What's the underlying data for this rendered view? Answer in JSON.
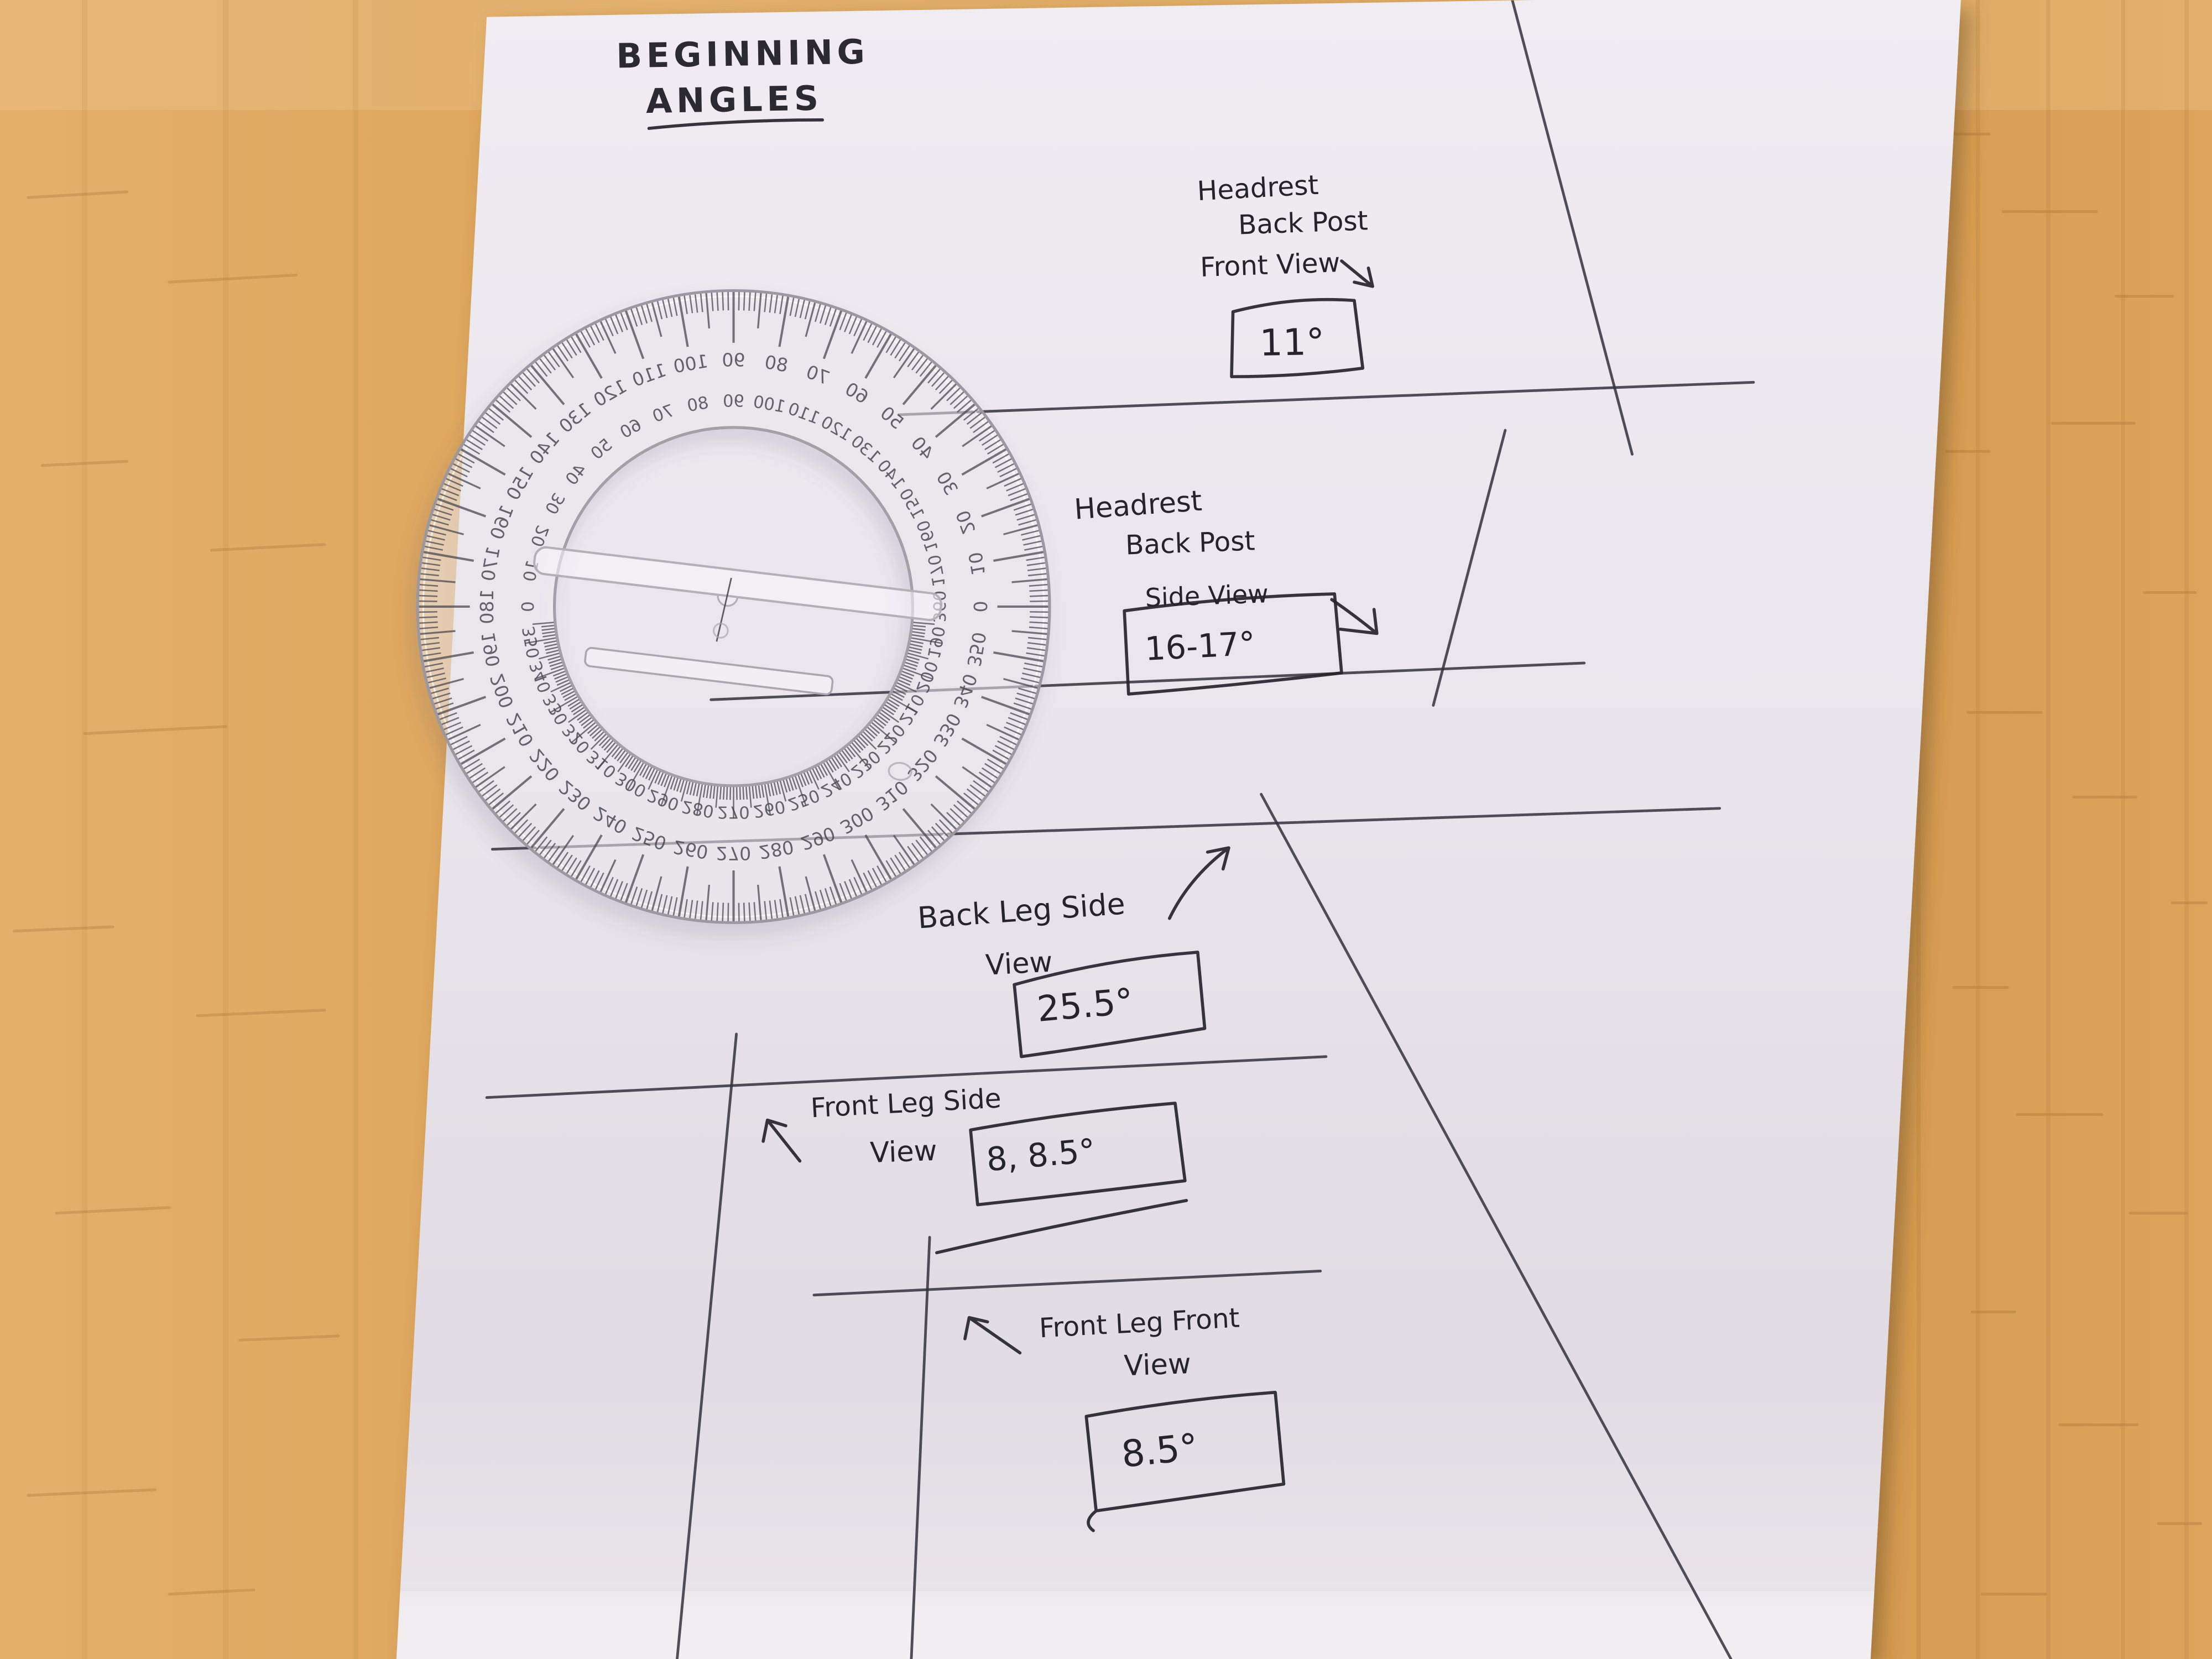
{
  "title": {
    "line1": "BEGINNING",
    "line2": "ANGLES"
  },
  "sections": {
    "headrest_front": {
      "l1": "Headrest",
      "l2": "Back Post",
      "l3": "Front View",
      "value": "11°"
    },
    "headrest_side": {
      "l1": "Headrest",
      "l2": "Back Post",
      "l3": "Side View",
      "value": "16-17°"
    },
    "back_leg_side": {
      "l1": "Back Leg Side",
      "l2": "View",
      "value": "25.5°"
    },
    "front_leg_side": {
      "l1": "Front Leg Side",
      "l2": "View",
      "value": "8, 8.5°"
    },
    "front_leg_front": {
      "l1": "Front Leg Front",
      "l2": "View",
      "value": "8.5°"
    }
  },
  "protractor": {
    "mirrored": true,
    "outer_labels": [
      "0",
      "10",
      "20",
      "30",
      "40",
      "50",
      "60",
      "70",
      "80",
      "90",
      "100",
      "110",
      "120",
      "130",
      "140",
      "150",
      "160",
      "170",
      "180",
      "190",
      "200",
      "210",
      "220",
      "230",
      "240",
      "250",
      "260",
      "270",
      "280",
      "290",
      "300",
      "310",
      "320",
      "330",
      "340",
      "350"
    ],
    "inner_labels": [
      "360",
      "170",
      "160",
      "150",
      "140",
      "130",
      "120",
      "110",
      "100",
      "90",
      "80",
      "70",
      "60",
      "50",
      "40",
      "30",
      "20",
      "10",
      "0",
      "350",
      "340",
      "330",
      "320",
      "310",
      "300",
      "290",
      "280",
      "270",
      "260",
      "250",
      "240",
      "230",
      "220",
      "210",
      "200",
      "190"
    ]
  },
  "colors": {
    "ink": "#26242b",
    "paper": "#e9e5ec",
    "wood_light": "#e7b372",
    "wood_dark": "#d1964b",
    "plastic_edge": "#9b98a1",
    "tick": "#4a4950"
  }
}
